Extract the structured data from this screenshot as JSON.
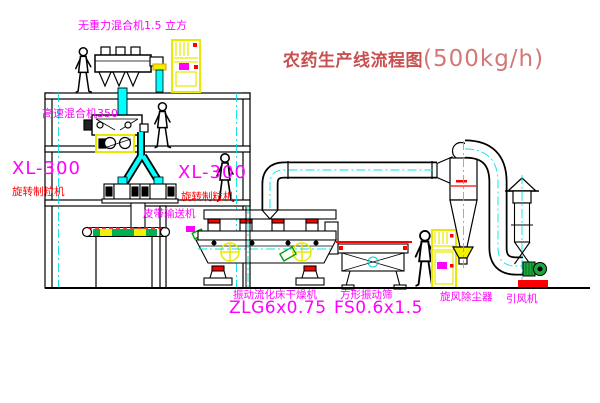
{
  "title": {
    "name": "农药生产线流程图",
    "capacity": "(500kg/h)"
  },
  "labels": {
    "gravity_mixer": "无重力混合机1.5 立方",
    "high_speed_mixer": "高速混合机350",
    "granulator_left_model": "XL-300",
    "granulator_left_name": "旋转制粒机",
    "granulator_right_model": "XL-300",
    "granulator_right_name": "旋转制粒机",
    "belt_conveyor": "皮带输送机",
    "dryer_name": "振动流化床干燥机",
    "dryer_model": "ZLG6x0.75",
    "sieve_name": "方形振动筛",
    "sieve_model": "FS0.6x1.5",
    "cyclone": "旋风除尘器",
    "fan": "引风机"
  },
  "colors": {
    "label_magenta": "#FF00FF",
    "label_red": "#FF0000",
    "title_red": "#C85050",
    "line_black": "#000000",
    "centerline_cyan": "#00E5E5",
    "equipment_yellow": "#F0F000",
    "fan_green": "#1FA83C",
    "base_red": "#FF0000"
  }
}
